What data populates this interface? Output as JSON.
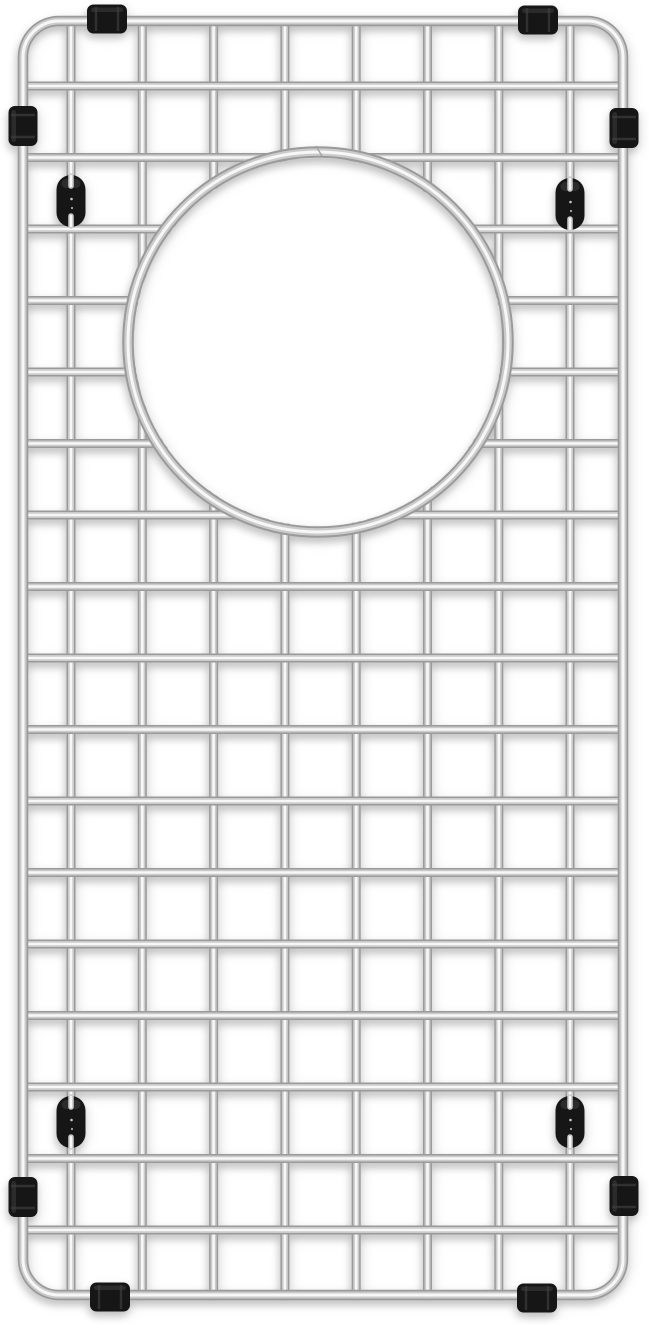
{
  "scene": {
    "type": "product-photo",
    "subject": "stainless steel kitchen sink bottom grid with circular drain opening, black rubber bumpers and feet",
    "background_color": "#ffffff"
  },
  "palette": {
    "steel_edge": "#9a9a9a",
    "steel_mid": "#cbcbcb",
    "steel_highlight": "#f7f7f7",
    "rubber_black": "#161616",
    "rubber_sheen": "#3f3f3f",
    "rubber_ridge": "#343434",
    "seam_gray": "#9f9f9f",
    "speck_white": "#e9e9e9"
  },
  "canvas": {
    "width": 650,
    "height": 1325
  },
  "frame": {
    "x": 23,
    "y": 21,
    "width": 600,
    "height": 1274,
    "corner_radius": 36,
    "wire": {
      "outer": 10.5,
      "mid": 7,
      "core": 3
    }
  },
  "grid": {
    "columns": 9,
    "rows": 18,
    "vertical_wires_x": [
      71,
      142.3,
      213.6,
      284.9,
      356.2,
      427.5,
      498.8,
      570
    ],
    "horizontal_wires_y": [
      86,
      157.5,
      229,
      300.5,
      372,
      443.5,
      515,
      586.5,
      658,
      729.5,
      801,
      872.5,
      944,
      1015.5,
      1087,
      1158.5,
      1230
    ],
    "wire": {
      "outer": 9,
      "mid": 6,
      "core": 2.6
    }
  },
  "drain_opening": {
    "cx": 318,
    "cy": 342,
    "ring_radius": 190,
    "hole_radius": 184,
    "wire": {
      "outer": 11.5,
      "mid": 7.5,
      "core": 3
    },
    "seam": {
      "x1": 316,
      "y1": 146,
      "x2": 322,
      "y2": 156
    }
  },
  "feet": [
    {
      "cx": 71,
      "cy": 201
    },
    {
      "cx": 570,
      "cy": 204
    },
    {
      "cx": 71,
      "cy": 1122
    },
    {
      "cx": 570,
      "cy": 1122
    }
  ],
  "foot_size": {
    "width": 29,
    "height": 52,
    "corner_radius": 14.5,
    "notch_length": 10
  },
  "bumpers": [
    {
      "cx": 107,
      "cy": 19,
      "orientation": "horizontal"
    },
    {
      "cx": 538,
      "cy": 20,
      "orientation": "horizontal"
    },
    {
      "cx": 110,
      "cy": 1297,
      "orientation": "horizontal"
    },
    {
      "cx": 537,
      "cy": 1298,
      "orientation": "horizontal"
    },
    {
      "cx": 23,
      "cy": 126,
      "orientation": "vertical"
    },
    {
      "cx": 624,
      "cy": 128,
      "orientation": "vertical"
    },
    {
      "cx": 23,
      "cy": 1197,
      "orientation": "vertical"
    },
    {
      "cx": 624,
      "cy": 1196,
      "orientation": "vertical"
    }
  ],
  "bumper_size": {
    "length": 40,
    "girth": 29,
    "corner_radius": 6.5
  }
}
